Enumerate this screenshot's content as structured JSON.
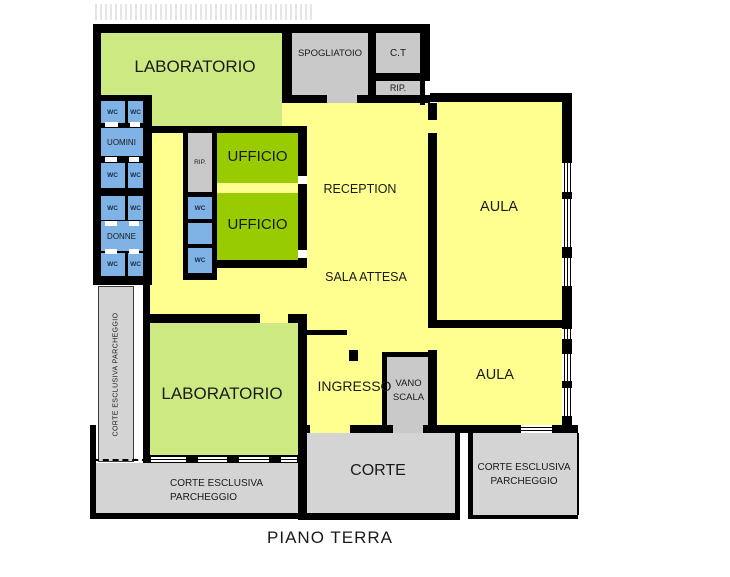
{
  "title": "PIANO TERRA",
  "colors": {
    "hall_yellow": "#FFFF8F",
    "laboratorio_green": "#CDEA82",
    "ufficio_green": "#99CC00",
    "wc_blue": "#7FB3E6",
    "service_gray": "#C9C9C9",
    "court_gray": "#D4D4D4",
    "wall_black": "#000000"
  },
  "rooms": {
    "laboratorio": "LABORATORIO",
    "spogliatoio": "SPOGLIATOIO",
    "ct": "C.T",
    "rip": "RIP.",
    "wc": "WC",
    "uomini": "UOMINI",
    "donne": "DONNE",
    "ufficio": "UFFICIO",
    "reception": "RECEPTION",
    "sala_attesa": "SALA ATTESA",
    "aula": "AULA",
    "ingresso": "INGRESSO",
    "vano_scala": "VANO SCALA",
    "corte": "CORTE",
    "corte_esclusiva_parcheggio": "CORTE ESCLUSIVA PARCHEGGIO"
  }
}
